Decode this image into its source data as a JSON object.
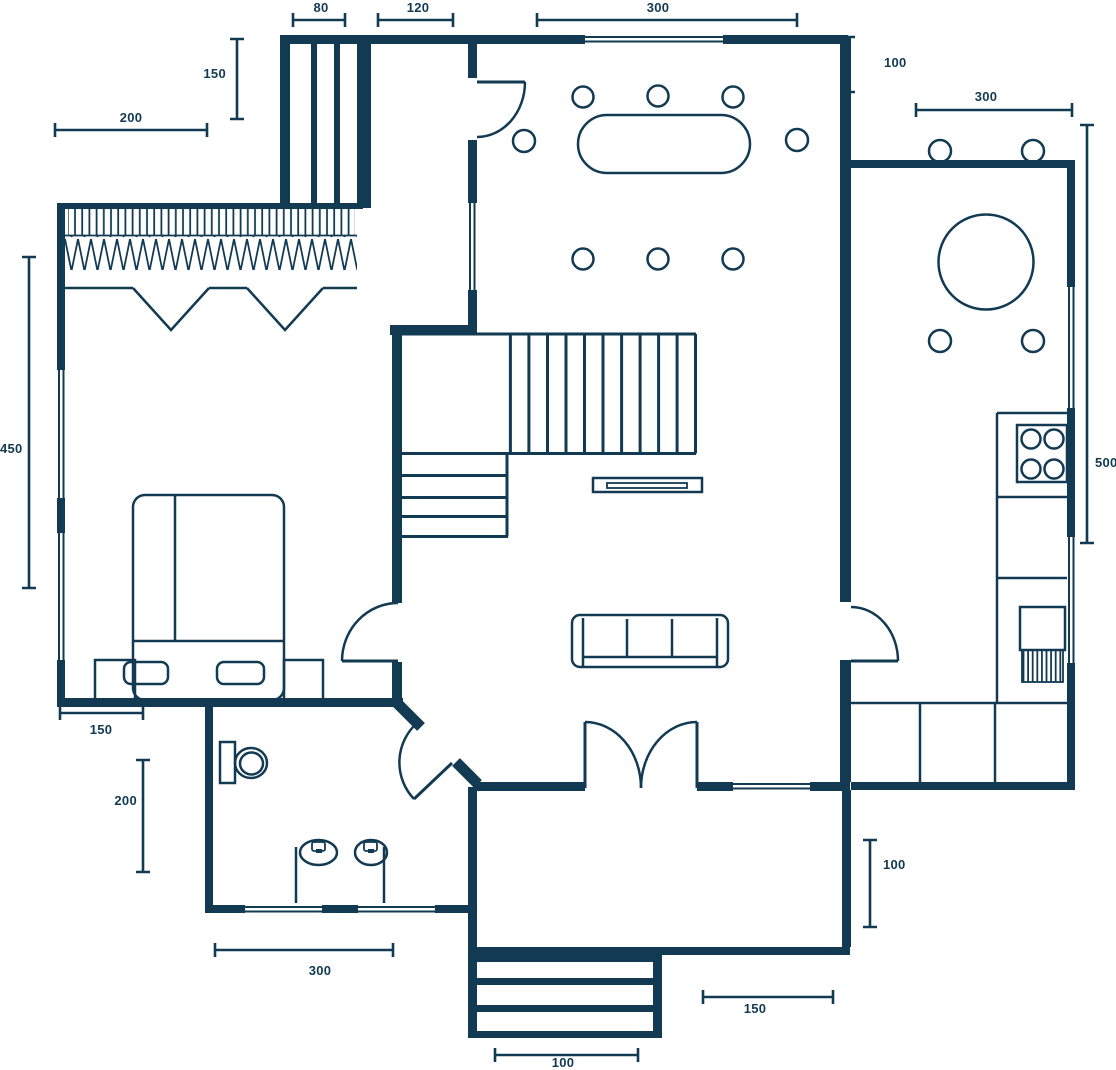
{
  "title": "Apartment floor plan drawing",
  "colors": {
    "ink": "#123a52",
    "background": "#ffffff"
  },
  "dims": [
    {
      "name": "entry-closet-width",
      "value": "80"
    },
    {
      "name": "hallway-width",
      "value": "120"
    },
    {
      "name": "dining-room-width",
      "value": "300"
    },
    {
      "name": "entry-closet-depth",
      "value": "150"
    },
    {
      "name": "wardrobe-width",
      "value": "200"
    },
    {
      "name": "dining-kitchen-gap",
      "value": "100"
    },
    {
      "name": "kitchen-width",
      "value": "300"
    },
    {
      "name": "kitchen-depth",
      "value": "500"
    },
    {
      "name": "bedroom-depth",
      "value": "450"
    },
    {
      "name": "bed-width",
      "value": "150"
    },
    {
      "name": "bathroom-depth",
      "value": "200"
    },
    {
      "name": "bathroom-width",
      "value": "300"
    },
    {
      "name": "porch-width",
      "value": "150"
    },
    {
      "name": "entry-steps-width",
      "value": "100"
    },
    {
      "name": "porch-depth",
      "value": "100"
    }
  ]
}
